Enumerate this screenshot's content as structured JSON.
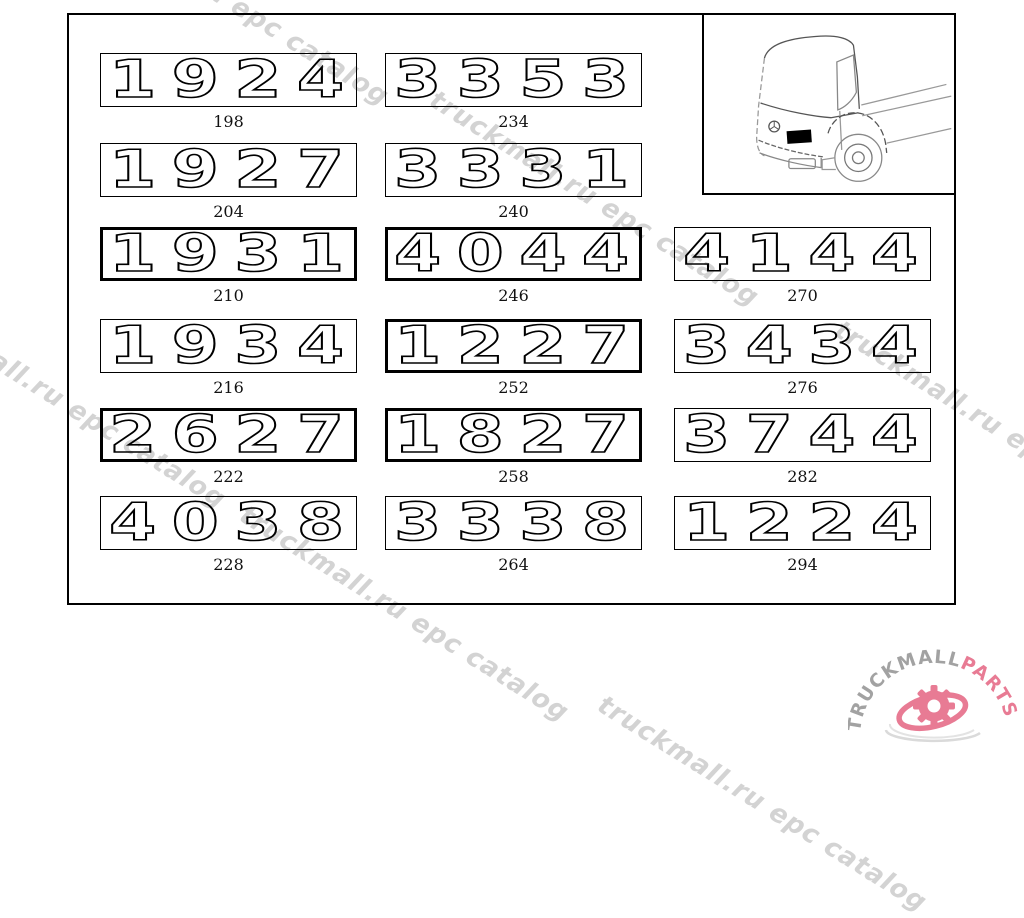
{
  "watermark": {
    "text": "truckmall.ru epc catalog",
    "color": "#d3d3d3",
    "instances": [
      {
        "x": 70,
        "y": -116
      },
      {
        "x": 440,
        "y": 85
      },
      {
        "x": -93,
        "y": 287
      },
      {
        "x": 845,
        "y": 315
      },
      {
        "x": 250,
        "y": 500
      },
      {
        "x": 608,
        "y": 690
      }
    ]
  },
  "board": {
    "badges": [
      {
        "model": "1924",
        "ref": "198",
        "col": 0,
        "row": 0,
        "thick": false
      },
      {
        "model": "3353",
        "ref": "234",
        "col": 1,
        "row": 0,
        "thick": false
      },
      {
        "model": "1927",
        "ref": "204",
        "col": 0,
        "row": 1,
        "thick": false
      },
      {
        "model": "3331",
        "ref": "240",
        "col": 1,
        "row": 1,
        "thick": false
      },
      {
        "model": "1931",
        "ref": "210",
        "col": 0,
        "row": 2,
        "thick": true
      },
      {
        "model": "4044",
        "ref": "246",
        "col": 1,
        "row": 2,
        "thick": true
      },
      {
        "model": "4144",
        "ref": "270",
        "col": 2,
        "row": 2,
        "thick": false
      },
      {
        "model": "1934",
        "ref": "216",
        "col": 0,
        "row": 3,
        "thick": false
      },
      {
        "model": "1227",
        "ref": "252",
        "col": 1,
        "row": 3,
        "thick": true
      },
      {
        "model": "3434",
        "ref": "276",
        "col": 2,
        "row": 3,
        "thick": false
      },
      {
        "model": "2627",
        "ref": "222",
        "col": 0,
        "row": 4,
        "thick": true
      },
      {
        "model": "1827",
        "ref": "258",
        "col": 1,
        "row": 4,
        "thick": true
      },
      {
        "model": "3744",
        "ref": "282",
        "col": 2,
        "row": 4,
        "thick": false
      },
      {
        "model": "4038",
        "ref": "228",
        "col": 0,
        "row": 5,
        "thick": false
      },
      {
        "model": "3338",
        "ref": "264",
        "col": 1,
        "row": 5,
        "thick": false
      },
      {
        "model": "1224",
        "ref": "294",
        "col": 2,
        "row": 5,
        "thick": false
      }
    ]
  },
  "truck_thumbnail": {
    "icon": "truck-cab-front-line-drawing-icon",
    "marker_icon": "badge-location-marker",
    "marker_color": "#000000"
  },
  "logo": {
    "text_gray": "TRUCKMALL",
    "text_pink": "PARTS",
    "color_gray": "#a2a2a2",
    "color_pink": "#e87b94",
    "icon": "gear-swoosh-icon"
  }
}
